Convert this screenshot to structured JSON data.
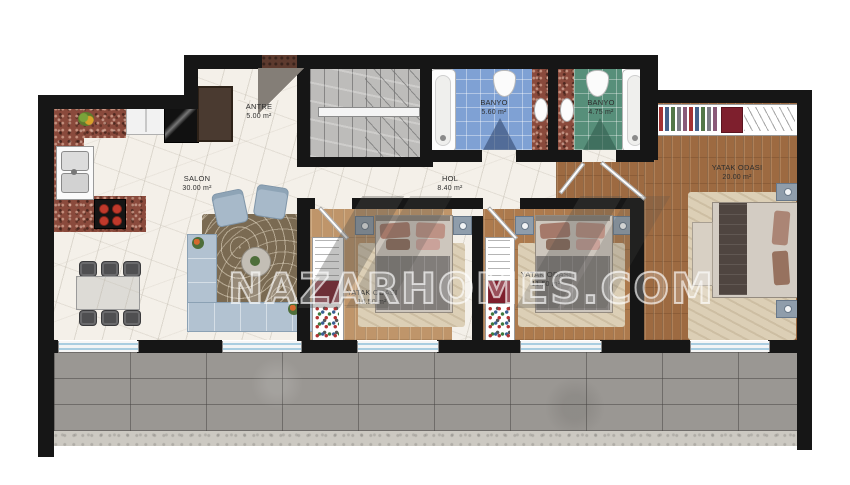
{
  "plan": {
    "watermark_text": "NAZARHOMES.COM",
    "rooms": [
      {
        "name": "ANTRE",
        "area": "5.00 m²"
      },
      {
        "name": "SALON",
        "area": "30.00 m²"
      },
      {
        "name": "HOL",
        "area": "8.40 m²"
      },
      {
        "name": "BANYO",
        "area": "5.60 m²"
      },
      {
        "name": "BANYO",
        "area": "4.75 m²"
      },
      {
        "name": "YATAK ODASI",
        "area": "10.50 m²"
      },
      {
        "name": "YATAK ODASI",
        "area": "11.50 m²"
      },
      {
        "name": "YATAK ODASI",
        "area": "20.00 m²"
      }
    ],
    "colors": {
      "wall": "#161616",
      "marble_floor": "#f4f0e9",
      "granite_counter": "#8a4a3c",
      "bath_blue_tile": "#7fa1d4",
      "bath_green_tile": "#578f7a",
      "wood_light": "#bf956a",
      "wood_mid": "#ad7a4d",
      "wood_dark": "#9d6a41",
      "balcony_tile": "#9a9793",
      "wardrobe_red": "#7e1f2d",
      "sofa_blue": "#b2c2d1"
    }
  }
}
